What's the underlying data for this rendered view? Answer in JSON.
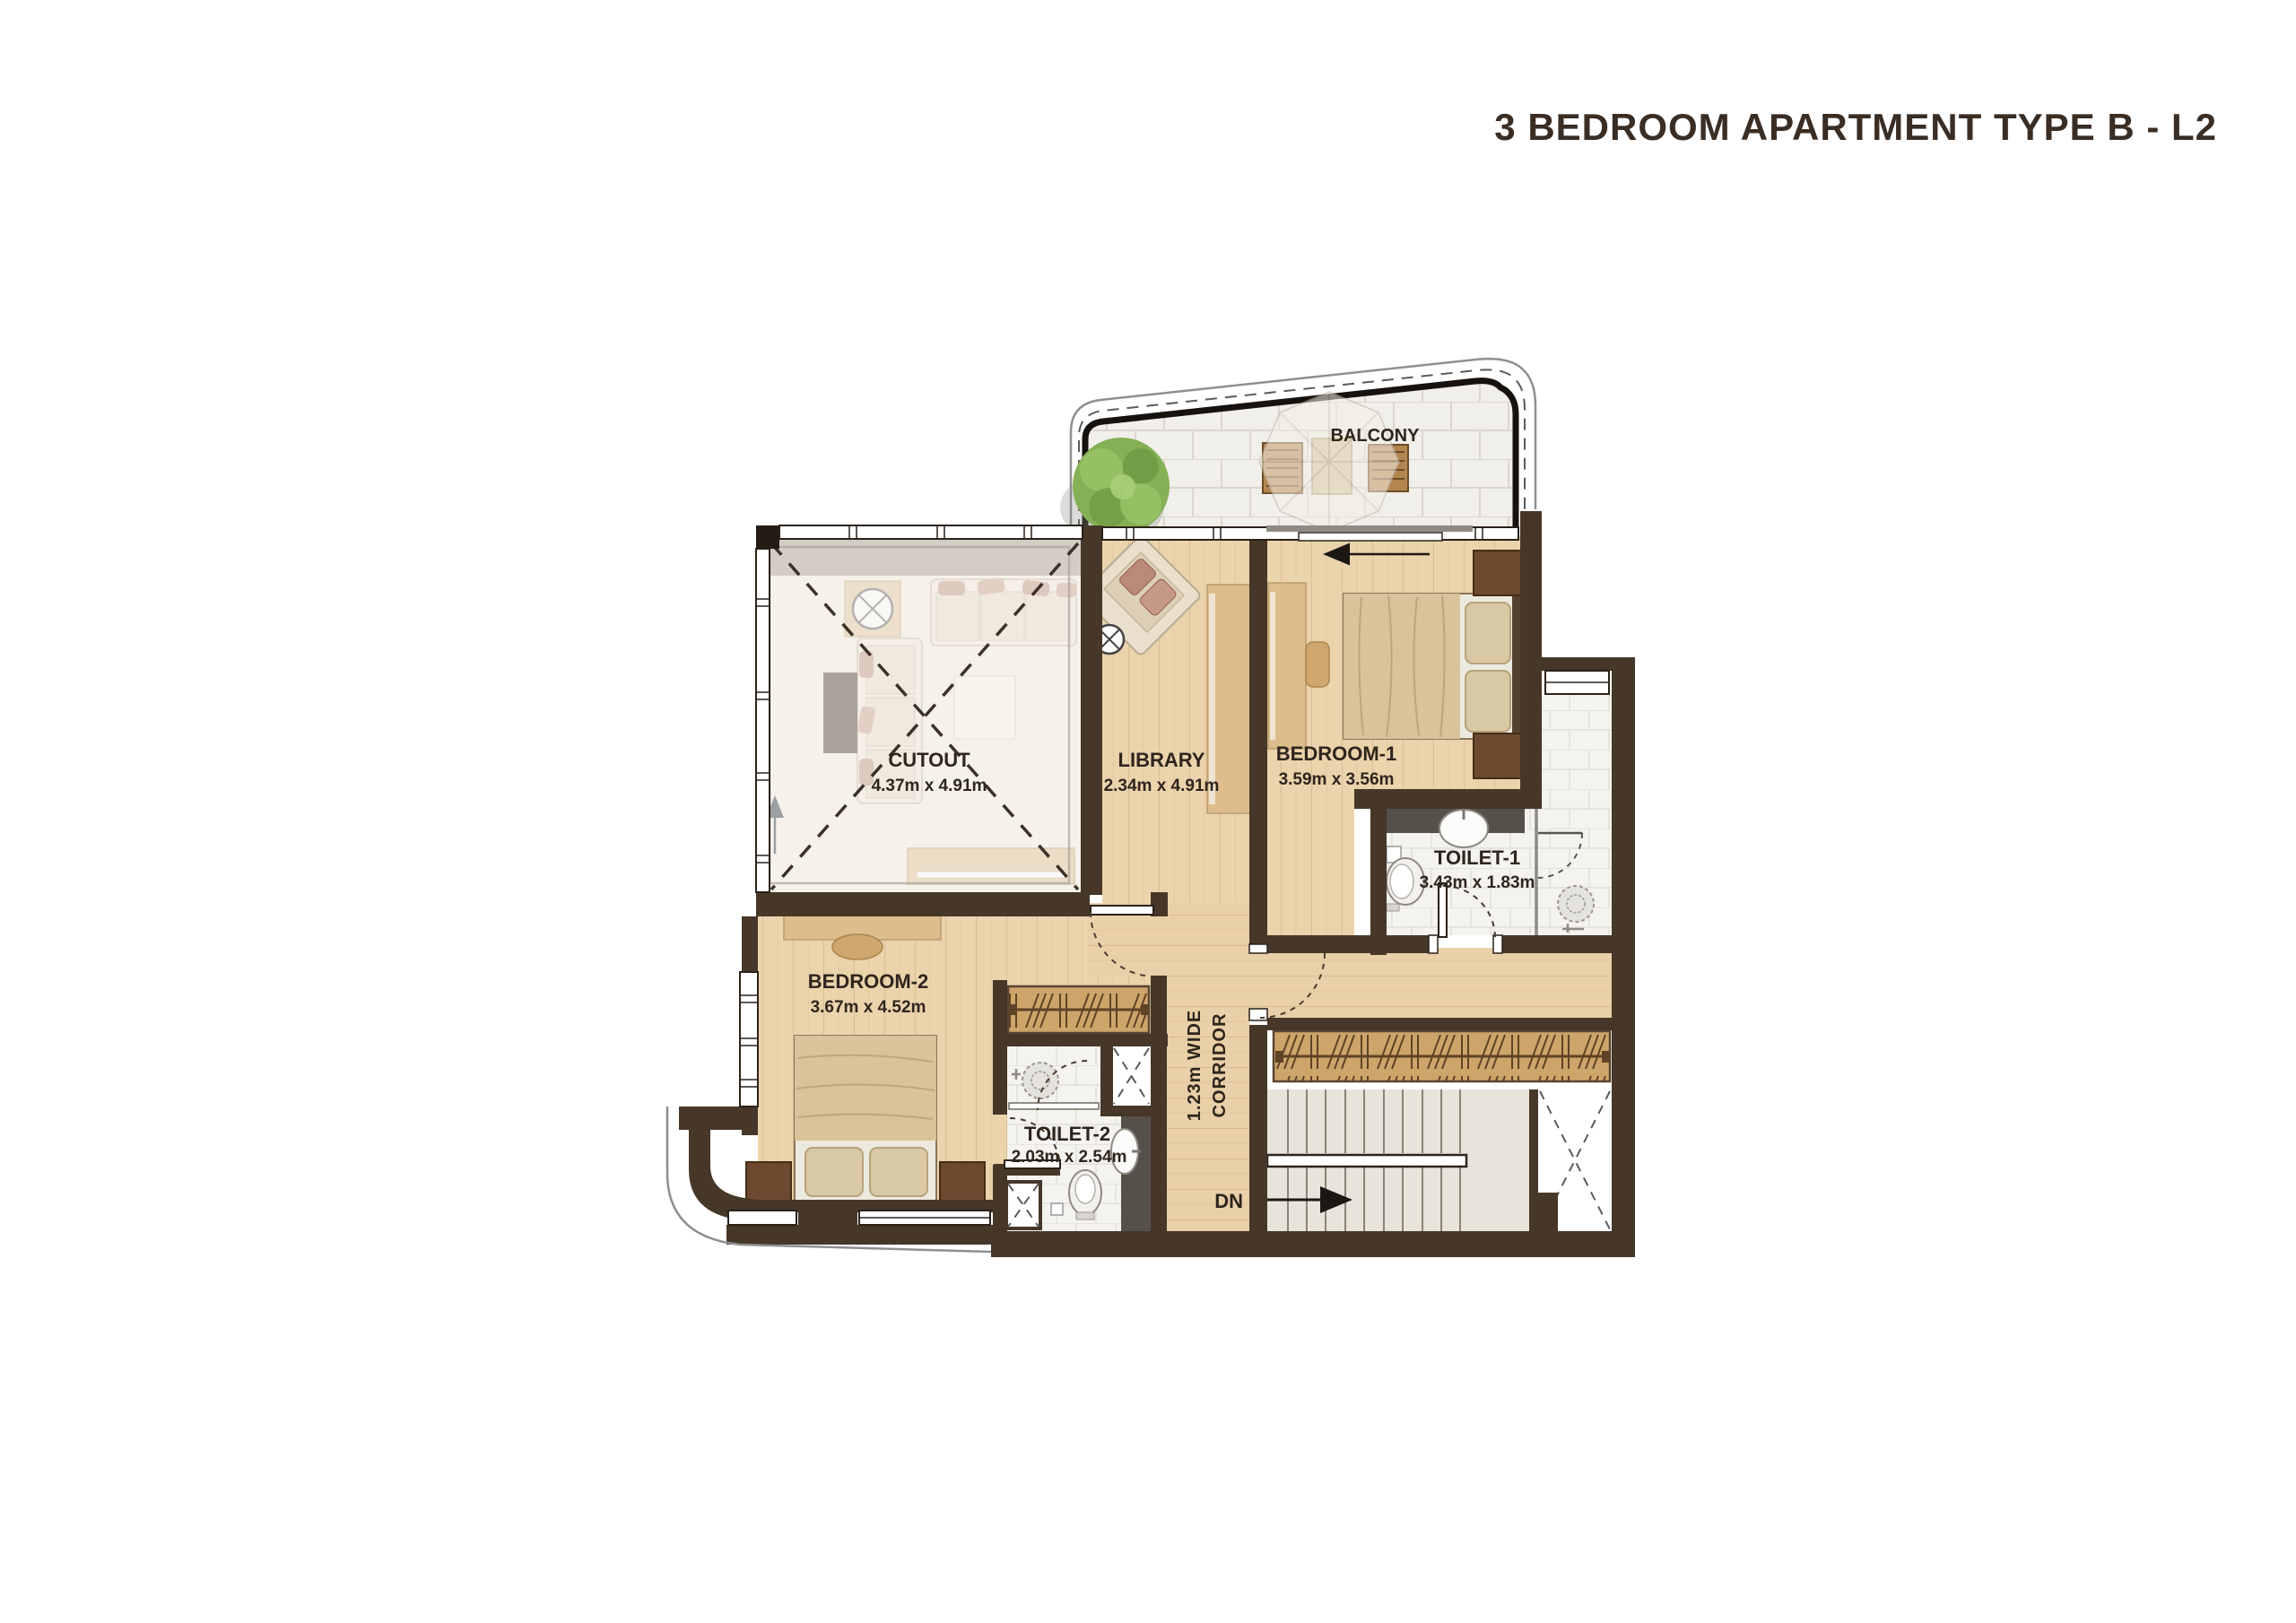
{
  "title": "3 BEDROOM APARTMENT TYPE B - L2",
  "rooms": {
    "balcony": {
      "name": "BALCONY"
    },
    "cutout": {
      "name": "CUTOUT",
      "dims": "4.37m x 4.91m"
    },
    "library": {
      "name": "LIBRARY",
      "dims": "2.34m x 4.91m"
    },
    "bedroom1": {
      "name": "BEDROOM-1",
      "dims": "3.59m x 3.56m"
    },
    "toilet1": {
      "name": "TOILET-1",
      "dims": "3.43m x 1.83m"
    },
    "bedroom2": {
      "name": "BEDROOM-2",
      "dims": "3.67m x 4.52m"
    },
    "toilet2": {
      "name": "TOILET-2",
      "dims": "2.03m x 2.54m"
    },
    "corridor": {
      "line1": "1.23m WIDE",
      "line2": "CORRIDOR"
    },
    "stairs": {
      "label": "DN"
    }
  },
  "colors": {
    "wall": "#463729",
    "wood_floor": "#ebd3ac",
    "tile_floor": "#f3f2ee",
    "cutout_floor": "#f3ebe0",
    "stair_floor": "#e9e4d9",
    "balcony_tile": "#f1efea",
    "closet_wood": "#cda56a",
    "furniture_wood": "#d9b787",
    "dark_furniture": "#6d4930",
    "bed_linen": "#d8c39a",
    "granite": "#55504a",
    "tree": "#85b055",
    "text": "#2e251d"
  }
}
